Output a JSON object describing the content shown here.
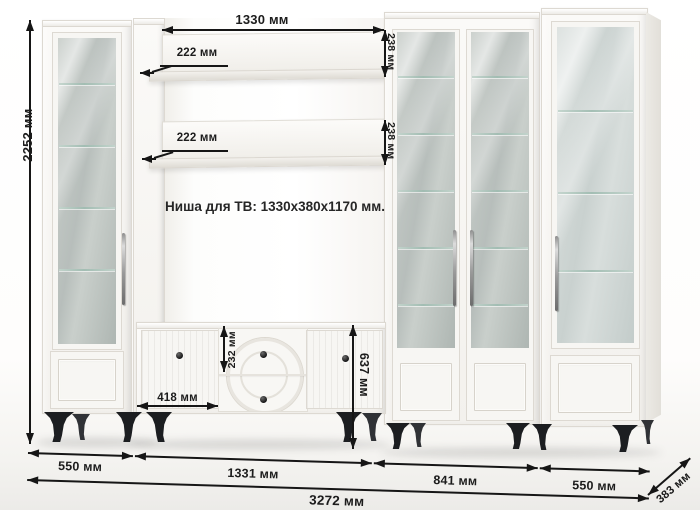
{
  "note": {
    "tv_niche": "Ниша для ТВ: 1330x380x1170 мм."
  },
  "dims": {
    "total_height": "2252 мм",
    "total_width": "3272 мм",
    "depth": "383 мм",
    "niche_width": "1330 мм",
    "shelf_depth_top": "222 мм",
    "shelf_depth_mid": "222 мм",
    "shelf_clearance_top": "238 мм",
    "shelf_clearance_mid": "238 мм",
    "stand_door_width": "418 мм",
    "drawer_height": "232 мм",
    "stand_height": "637 мм",
    "width_left_cabinet": "550 мм",
    "width_tv_section": "1331 мм",
    "width_bookcase": "841 мм",
    "width_right_cabinet": "550 мм"
  },
  "colors": {
    "annotation": "#161616",
    "furniture_white": "#f6f5f2",
    "glass": "#b9c0bc",
    "legs": "#1c1e21"
  }
}
